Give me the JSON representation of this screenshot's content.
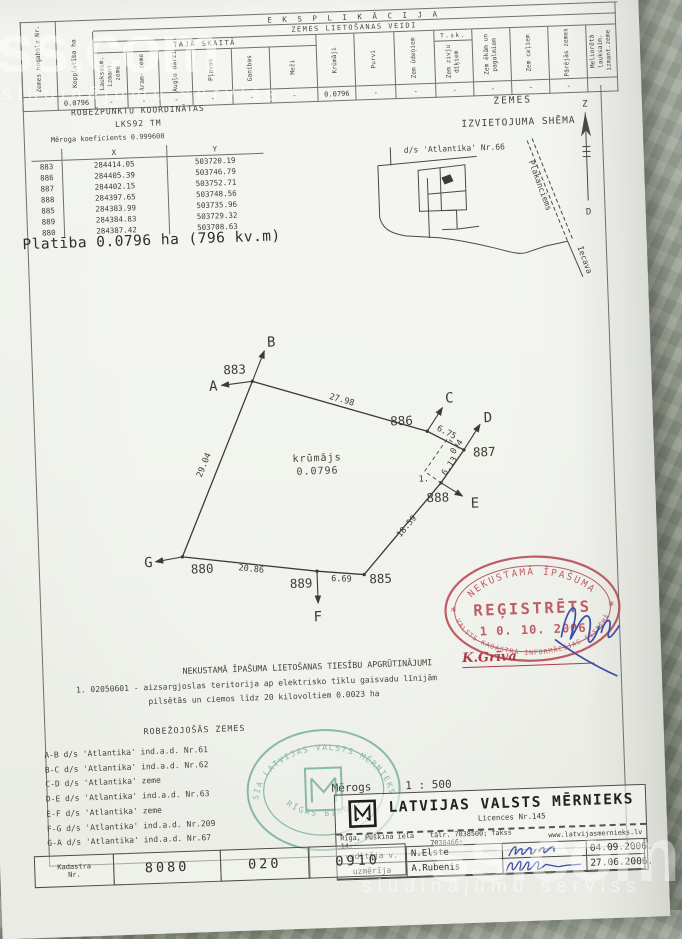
{
  "watermark": {
    "brand": "ss.com",
    "tagline": "sludinājumu serviss"
  },
  "colors": {
    "stamp_red": "#b5434e",
    "stamp_green": "#5ea28a",
    "signature_blue": "#3c4ea8",
    "ink": "#3f3f39",
    "paper": "#f0f1ec"
  },
  "explication": {
    "title": "E K S P L I K Ā C I J A",
    "subtitle": "ZEMES LIETOŠANAS VEIDI",
    "subgroup": "TAJĀ SKAITĀ",
    "tsk": "T.sk.",
    "columns": [
      "Zemes nogabala Nr.",
      "Kopplatība ha",
      "Lauksaim. izmant. zeme",
      "Aram- zeme",
      "Augļu dārzi",
      "Pļavas",
      "Ganības",
      "Meži",
      "Krūmāji",
      "Purvi",
      "Zem ūdeņiem",
      "Zem zivju dīķiem",
      "Zem ēkām un pagalmiem",
      "Zem ceļiem",
      "Pārējās zemes",
      "Meliorētā lauksaim. izmant.zeme"
    ],
    "values": [
      "",
      "0.0796",
      "-",
      "-",
      "-",
      "-",
      "-",
      "-",
      "0.0796",
      "-",
      "-",
      "-",
      "-",
      "-",
      "-",
      ""
    ]
  },
  "coords": {
    "title": "ROBEŽPUNKTU KOORDINĀTAS",
    "system": "LKS92 TM",
    "note": "Mēroga koeficients 0.999600",
    "col_x": "X",
    "col_y": "Y",
    "rows": [
      {
        "id": "883",
        "x": "284414.05",
        "y": "503720.19"
      },
      {
        "id": "886",
        "x": "284405.39",
        "y": "503746.79"
      },
      {
        "id": "887",
        "x": "284402.15",
        "y": "503752.71"
      },
      {
        "id": "888",
        "x": "284397.65",
        "y": "503748.56"
      },
      {
        "id": "885",
        "x": "284383.99",
        "y": "503735.96"
      },
      {
        "id": "889",
        "x": "284384.83",
        "y": "503729.32"
      },
      {
        "id": "880",
        "x": "284387.42",
        "y": "503708.63"
      }
    ],
    "area_line": "Platība 0.0796 ha (796 kv.m)"
  },
  "schema": {
    "title1": "ZEMES",
    "title2": "IZVIETOJUMA SHĒMA",
    "parcel": "d/s 'Atlantika' Nr.66",
    "road": "Plakanciems",
    "place": "Iecava",
    "north": "Z",
    "south": "D"
  },
  "plot": {
    "area_type": "krūmājs",
    "area_value": "0.0796",
    "points": {
      "p883": "883",
      "p886": "886",
      "p887": "887",
      "p888": "888",
      "p885": "885",
      "p889": "889",
      "p880": "880"
    },
    "letters": {
      "a": "A",
      "b": "B",
      "c": "C",
      "d": "D",
      "e": "E",
      "f": "F",
      "g": "G"
    },
    "lengths": {
      "l883_886": "27.98",
      "l886_887": "6.75",
      "l887x": "0.4",
      "l887_888": "6.13",
      "l888_885": "18.59",
      "l885_889": "6.69",
      "l889_880": "20.86",
      "l880_883": "29.04",
      "offset_width": "1."
    }
  },
  "stamp": {
    "arc_top": "NEKUSTAMĀ ĪPAŠUMA",
    "center": "REĢISTRĒTS",
    "date": "1 0.  10.  2006",
    "arc_bottom": "VALSTS KADASTRA INFORMĀCIJAS SISTĒMĀ",
    "star_left": "*",
    "star_right": "*",
    "signer": "K.Grīva"
  },
  "encumbrances": {
    "title": "NEKUSTAMĀ ĪPAŠUMA LIETOŠANAS TIESĪBU APGRŪTINĀJUMI",
    "line1": "1. 02050601 - aizsargjoslas teritorija ap elektrisko tīklu gaisvadu līnijām",
    "line2": "pilsētās un ciemos līdz 20 kilovoltiem 0.0023 ha"
  },
  "bordering": {
    "title": "ROBEŽOJOŠĀS ZEMES",
    "items": [
      "A-B d/s 'Atlantika' ind.a.d. Nr.61",
      "B-C d/s 'Atlantika' ind.a.d. Nr.62",
      "C-D d/s 'Atlantika' zeme",
      "D-E d/s 'Atlantika' ind.a.d. Nr.63",
      "E-F d/s 'Atlantika' zeme",
      "F-G d/s 'Atlantika' ind.a.d. Nr.209",
      "G-A d/s 'Atlantika' ind.a.d. Nr.67"
    ]
  },
  "green_stamp": {
    "arc_top": "SIA LATVIJAS VALSTS MĒRNIEKS",
    "arc_bottom": "RĪGAS BIROJS"
  },
  "scale": {
    "label": "Mērogs",
    "value": "1 : 500"
  },
  "company": {
    "name": "LATVIJAS VALSTS MĒRNIEKS",
    "licence": "Licences Nr.145",
    "address": "Rīga, Puškina iela 14;",
    "phone": "tālr. 7038500;  fakss 7038466;",
    "web": "www.latvijasmernieks.lv",
    "rows": [
      {
        "role": "vadītāja v.",
        "name": "N.Elste",
        "date": "04.09.2006."
      },
      {
        "role": "uzmērīja",
        "name": "A.Rubenis",
        "date": "27.06.2006."
      }
    ]
  },
  "kadastra": {
    "label1": "Kadastra",
    "label2": "Nr.",
    "cells": [
      "8080",
      "020",
      "0910"
    ]
  }
}
